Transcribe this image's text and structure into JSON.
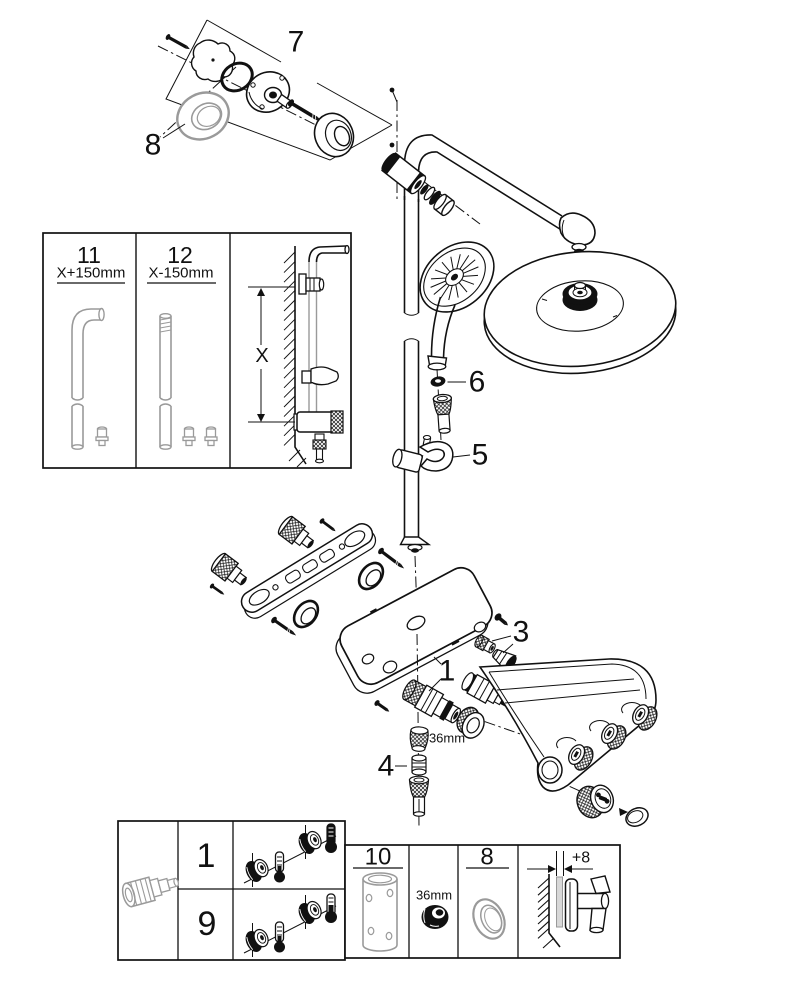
{
  "colors": {
    "ink": "#111111",
    "grey_part": "#9a9a9a",
    "background": "#ffffff"
  },
  "callouts": {
    "wall_mount_detail": "7",
    "wall_rosette": "8",
    "hose_oring": "6",
    "hand_shower_holder": "5",
    "thermostat_cartridge": "1",
    "diverter_cartridge": "2",
    "volume_control": "3",
    "check_valve": "4",
    "nut_size": "36mm"
  },
  "inset": {
    "option_a": {
      "num": "11",
      "length": "X+150mm"
    },
    "option_b": {
      "num": "12",
      "length": "X-150mm"
    },
    "height_dim": "X"
  },
  "legend_left": {
    "row_top": "1",
    "row_bottom": "9"
  },
  "legend_right": {
    "tube": "10",
    "nut_size": "36mm",
    "rosette": "8",
    "offset": "+8"
  }
}
